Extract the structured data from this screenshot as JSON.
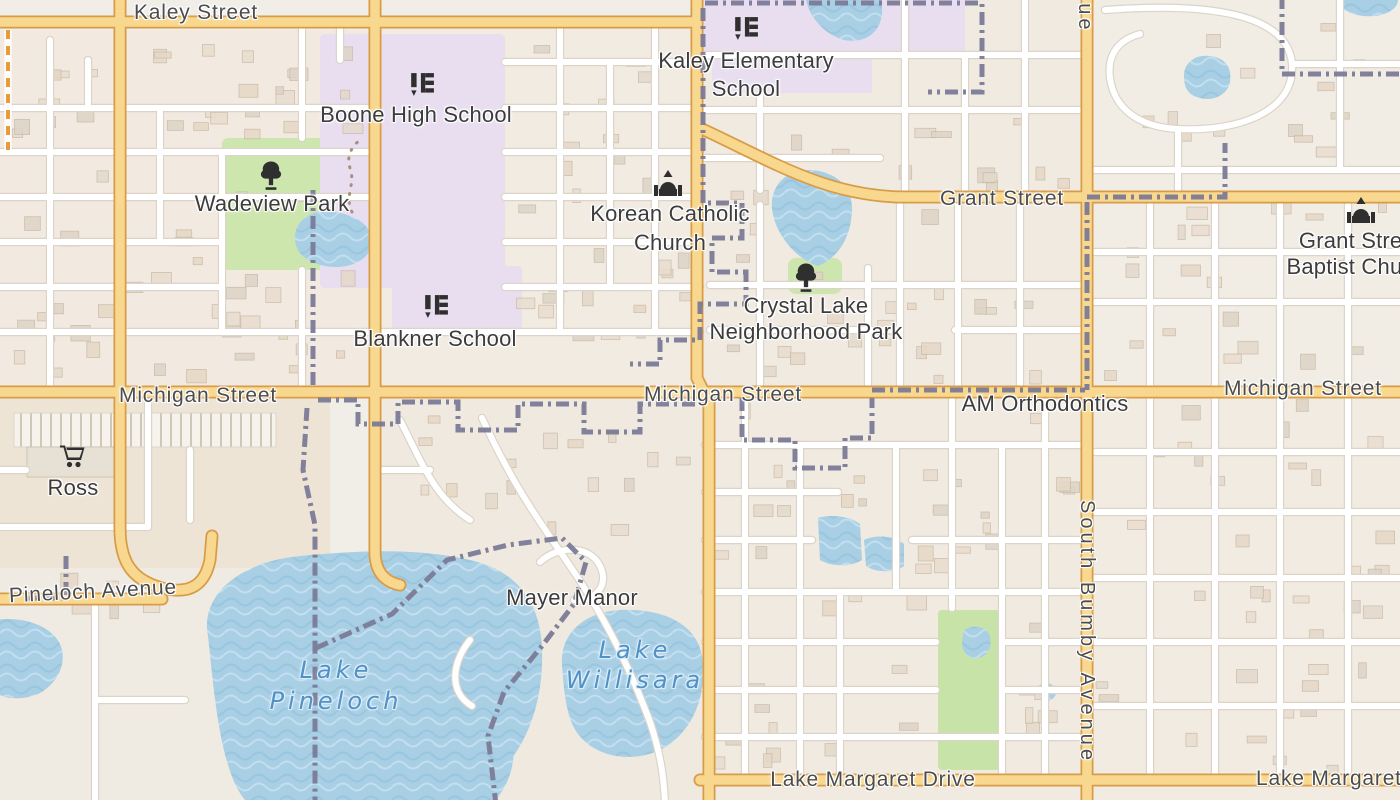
{
  "colors": {
    "land": "#f1eee8",
    "water": "#a9cfe4",
    "park_green": "#cde6ae",
    "school_lavender": "#e8def0",
    "major_road_fill": "#f8d88e",
    "major_road_casing": "#d89c48",
    "minor_road_fill": "#ffffff",
    "boundary": "#7a7996",
    "label_text": "#4c4c4c",
    "water_label_text": "#4e92c8"
  },
  "labels": {
    "roads": {
      "kaley": "Kaley Street",
      "grant": "Grant Street",
      "michigan_west": "Michigan Street",
      "michigan_center": "Michigan Street",
      "michigan_east": "Michigan Street",
      "pineloch": "Pineloch Avenue",
      "lake_margaret_center": "Lake Margaret Drive",
      "lake_margaret_east": "Lake Margaret Drive",
      "bumby_partial": "Avenue",
      "bumby": "South Bumby Avenue"
    },
    "places": {
      "boone": "Boone High School",
      "kaley_elementary": {
        "line1": "Kaley Elementary",
        "line2": "School"
      },
      "wadeview": "Wadeview Park",
      "korean_catholic": {
        "line1": "Korean Catholic",
        "line2": "Church"
      },
      "crystal_lake": {
        "line1": "Crystal Lake",
        "line2": "Neighborhood Park"
      },
      "blankner": "Blankner School",
      "grant_baptist": {
        "line1": "Grant Street",
        "line2": "Baptist Church"
      },
      "am_orthodontics": "AM Orthodontics",
      "ross": "Ross",
      "mayer_manor": "Mayer Manor"
    },
    "water": {
      "pineloch": {
        "line1": "Lake",
        "line2": "Pineloch"
      },
      "willisara": {
        "line1": "Lake",
        "line2": "Willisara"
      }
    }
  }
}
